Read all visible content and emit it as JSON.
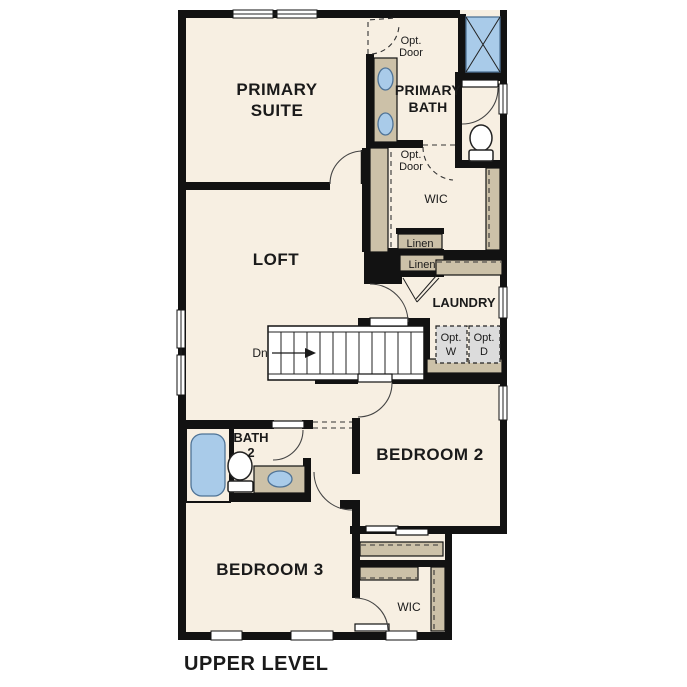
{
  "title": "UPPER LEVEL",
  "colors": {
    "background": "#ffffff",
    "floor": "#f7efe2",
    "wall": "#121212",
    "cabinet_tan": "#ccc1a8",
    "fixture_blue": "#a9cbe9",
    "optional_gray": "#dcdcdc",
    "text": "#1a1a1a"
  },
  "rooms": {
    "primary_suite": {
      "line1": "PRIMARY",
      "line2": "SUITE"
    },
    "primary_bath": {
      "line1": "PRIMARY",
      "line2": "BATH"
    },
    "wic_upper": {
      "label": "WIC"
    },
    "loft": {
      "label": "LOFT"
    },
    "laundry": {
      "label": "LAUNDRY"
    },
    "bath2": {
      "line1": "BATH",
      "line2": "2"
    },
    "bedroom2": {
      "label": "BEDROOM 2"
    },
    "bedroom3": {
      "label": "BEDROOM 3"
    },
    "wic_lower": {
      "label": "WIC"
    }
  },
  "annotations": {
    "opt_door_top": {
      "line1": "Opt.",
      "line2": "Door"
    },
    "opt_door_wic": {
      "line1": "Opt.",
      "line2": "Door"
    },
    "linen_upper": "Linen",
    "linen_lower": "Linen",
    "opt_washer": {
      "line1": "Opt.",
      "line2": "W"
    },
    "opt_dryer": {
      "line1": "Opt.",
      "line2": "D"
    },
    "stairs_down": "Dn"
  }
}
